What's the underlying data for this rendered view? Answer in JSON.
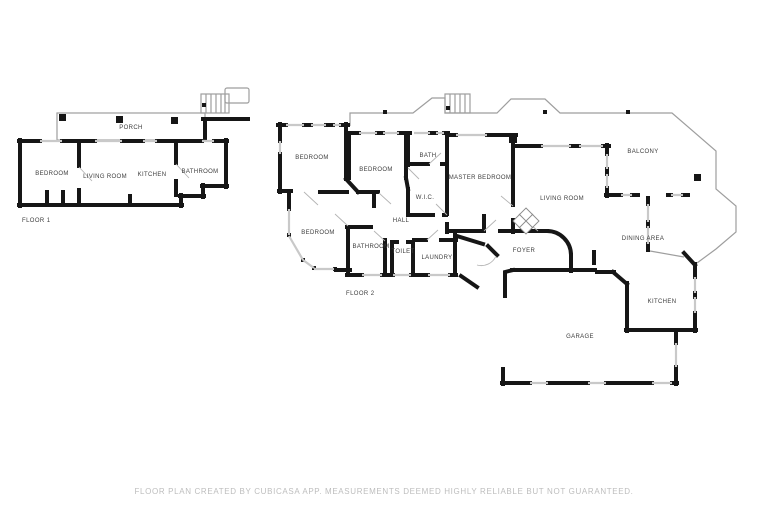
{
  "floor1": {
    "label": "FLOOR 1",
    "rooms": {
      "porch": "PORCH",
      "bedroom": "BEDROOM",
      "living_room": "LIVING ROOM",
      "kitchen": "KITCHEN",
      "bathroom": "BATHROOM"
    }
  },
  "floor2": {
    "label": "FLOOR 2",
    "rooms": {
      "bedroom_upper": "BEDROOM",
      "bedroom_middle": "BEDROOM",
      "bedroom_lower": "BEDROOM",
      "bath": "BATH",
      "master_bedroom": "MASTER BEDROOM",
      "wic": "W.I.C.",
      "hall": "HALL",
      "bathroom": "BATHROOM",
      "toilet": "TOILET",
      "laundry": "LAUNDRY",
      "living_room": "LIVING ROOM",
      "foyer": "FOYER",
      "balcony": "BALCONY",
      "dining_area": "DINING AREA",
      "kitchen": "KITCHEN",
      "garage": "GARAGE"
    }
  },
  "footer": {
    "disclaimer": "FLOOR PLAN CREATED BY CUBICASA APP. MEASUREMENTS DEEMED HIGHLY RELIABLE BUT NOT GUARANTEED."
  },
  "colors": {
    "wall": "#161616",
    "window": "#c9c9c9",
    "thin_outline": "#9e9e9e",
    "label_text": "#3d3d3d",
    "disclaimer_text": "#bdbdbd",
    "background": "#ffffff"
  }
}
